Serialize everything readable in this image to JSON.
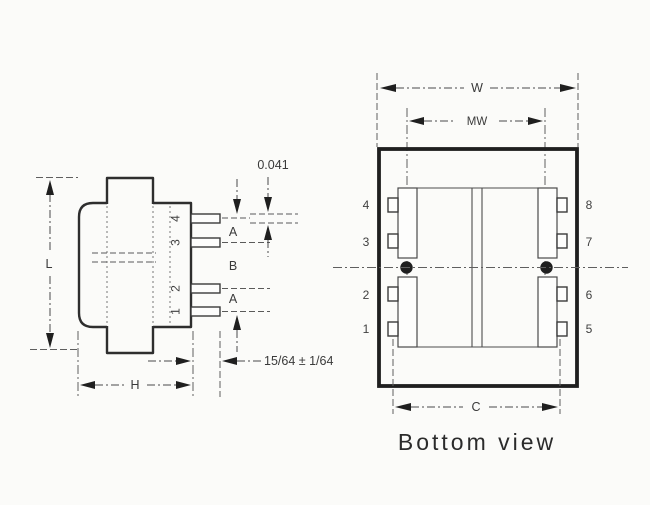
{
  "page": {
    "caption": "Bottom view",
    "ink_color": "#2e2e2e",
    "paper_color": "#fbfbf9"
  },
  "side_view": {
    "dims": {
      "length_label": "L",
      "height_label": "H",
      "pin_spacing_a_top": "A",
      "pin_spacing_b": "B",
      "pin_spacing_a_bottom": "A",
      "pin_thickness": "0.041",
      "pin_length_tolerance": "15/64 ± 1/64"
    },
    "pins": [
      {
        "label": "4"
      },
      {
        "label": "3"
      },
      {
        "label": "2"
      },
      {
        "label": "1"
      }
    ]
  },
  "bottom_view": {
    "dims": {
      "width_label": "W",
      "mounting_width_label": "MW",
      "pin_row_span_label": "C"
    },
    "left_pins": [
      {
        "label": "4"
      },
      {
        "label": "3"
      },
      {
        "label": "2"
      },
      {
        "label": "1"
      }
    ],
    "right_pins": [
      {
        "label": "8"
      },
      {
        "label": "7"
      },
      {
        "label": "6"
      },
      {
        "label": "5"
      }
    ]
  }
}
